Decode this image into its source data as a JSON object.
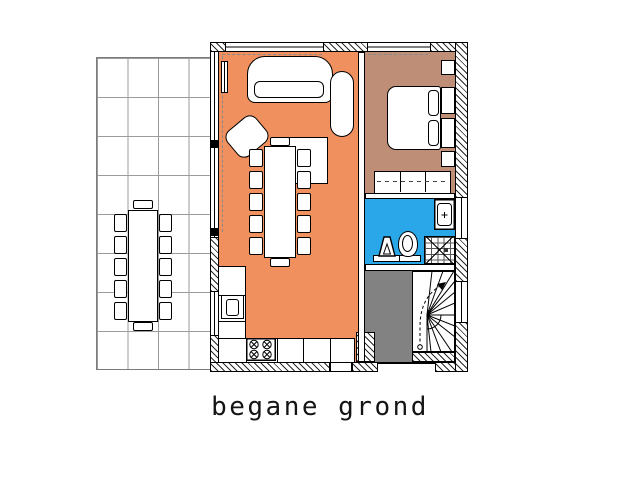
{
  "title": {
    "text": "begane grond"
  },
  "colors": {
    "living_room": "#F0905F",
    "bedroom": "#BE8E77",
    "bathroom": "#29A7E8",
    "hall": "#828282",
    "terrace_grid_line": "#9B9B9B",
    "wall_line": "#000000",
    "paper": "#FFFFFF"
  },
  "plan": {
    "floor_label": "begane grond",
    "rooms": [
      {
        "id": "terrace",
        "fill": "none",
        "features": [
          "tile grid",
          "garden table",
          "12 garden chairs"
        ]
      },
      {
        "id": "living-room",
        "fill": "living_room",
        "features": [
          "sofa",
          "armchair",
          "coffee table",
          "chaise longue",
          "dining table",
          "12 dining chairs",
          "radiator",
          "kitchen counter",
          "sink",
          "cooktop"
        ]
      },
      {
        "id": "bedroom",
        "fill": "bedroom",
        "features": [
          "double bed",
          "2 pillows",
          "side cabinets",
          "wardrobe"
        ]
      },
      {
        "id": "bathroom",
        "fill": "bathroom",
        "features": [
          "washbasin",
          "toilet",
          "hand basin",
          "shower"
        ]
      },
      {
        "id": "hall",
        "fill": "hall",
        "features": [
          "winder staircase",
          "entrance door"
        ]
      }
    ]
  }
}
